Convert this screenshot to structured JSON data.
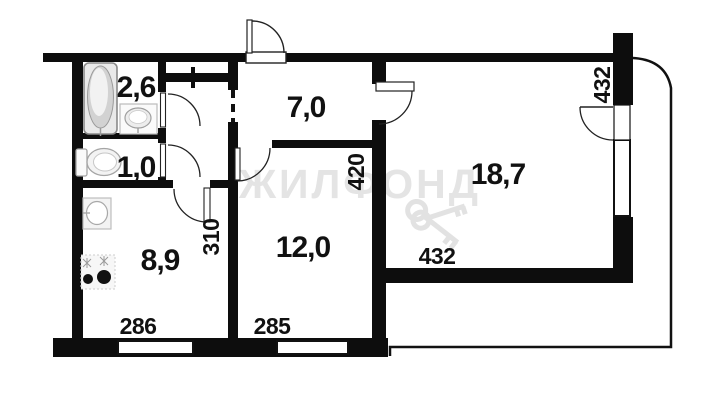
{
  "floor_plan": {
    "watermark": "ЖИЛФОНД",
    "rooms": {
      "bathroom": {
        "label": "2,6"
      },
      "toilet": {
        "label": "1,0"
      },
      "hallway": {
        "label": "7,0"
      },
      "living_room": {
        "label": "18,7"
      },
      "kitchen": {
        "label": "8,9"
      },
      "bedroom": {
        "label": "12,0"
      }
    },
    "dimensions": {
      "kitchen_width": "286",
      "bedroom_width": "285",
      "living_width": "432",
      "living_height": "432",
      "bedroom_height": "420",
      "kitchen_height": "310"
    },
    "colors": {
      "wall": "#0d0d0d",
      "background": "#ffffff",
      "watermark": "#e4e4e4"
    }
  }
}
